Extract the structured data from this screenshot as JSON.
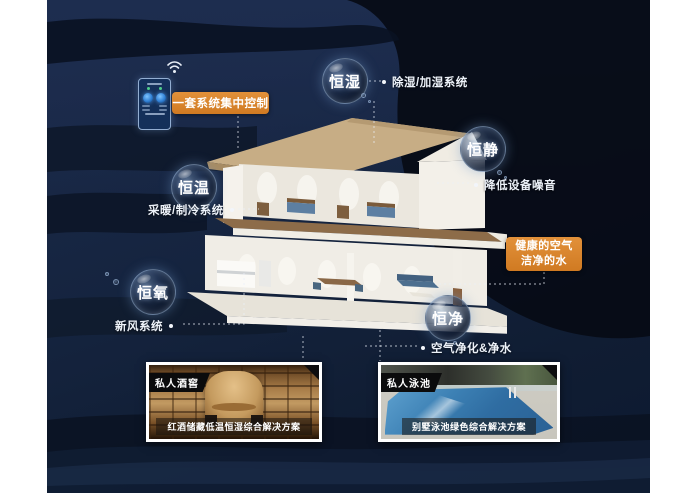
{
  "bubbles": [
    {
      "label": "恒湿",
      "desc": "除湿/加湿系统"
    },
    {
      "label": "恒静",
      "desc": "降低设备噪音"
    },
    {
      "label": "恒温",
      "desc": "采暖/制冷系统"
    },
    {
      "label": "恒氧",
      "desc": "新风系统"
    },
    {
      "label": "恒净",
      "desc": "空气净化&净水"
    }
  ],
  "callouts": {
    "central_control": "一套系统集中控制",
    "healthy_line1": "健康的空气",
    "healthy_line2": "洁净的水"
  },
  "photos": [
    {
      "tag": "私人酒窖",
      "caption": "红酒储藏低温恒湿综合解决方案"
    },
    {
      "tag": "私人泳池",
      "caption": "别墅泳池绿色综合解决方案"
    }
  ],
  "colors": {
    "accent_orange": "#D9842C",
    "background_navy": "#17273F"
  }
}
